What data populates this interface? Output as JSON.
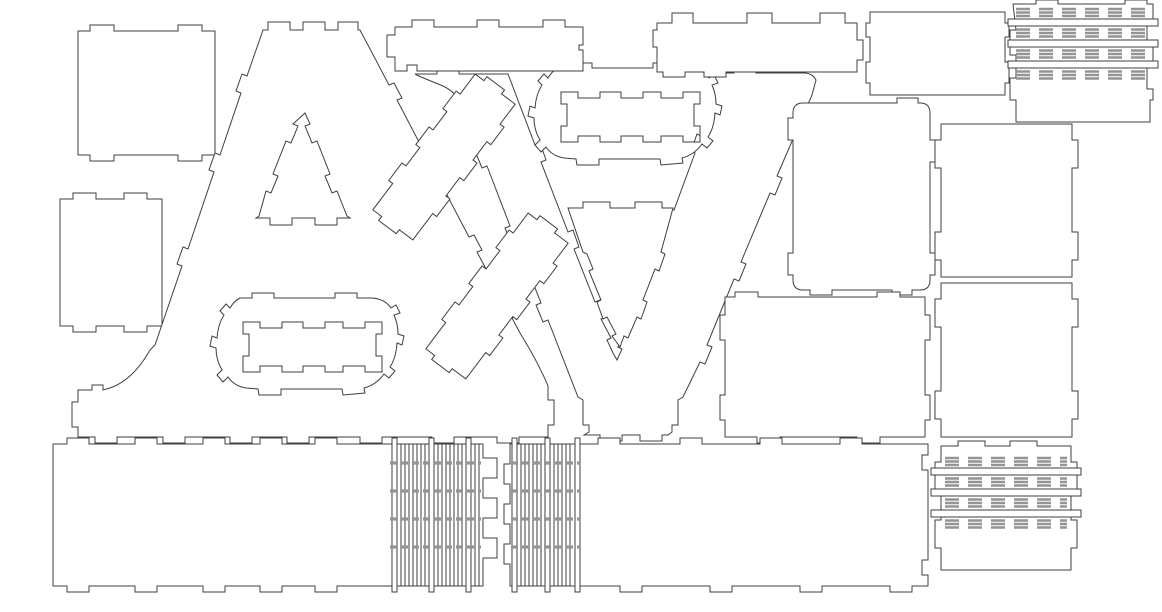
{
  "canvas": {
    "width": 1162,
    "height": 612,
    "background_color": "#ffffff",
    "cut_line_color": "#3f3f3f",
    "kerf_line_color": "#949494",
    "description": "laser-cut nesting sheet for 3D marquee letters A and V",
    "pieces": [
      {
        "name": "panel-square-top-left",
        "kind": "path",
        "d": "M78,31 L90,31 L90,25 L114,25 L114,31 L178,31 L178,25 L202,25 L202,31 L215,31 L215,155 L202,155 L202,161 L178,161 L178,155 L114,155 L114,161 L90,161 L90,155 L78,155 Z"
      },
      {
        "name": "panel-rect-left",
        "kind": "path",
        "d": "M60,199 L73,199 L73,193 L96,193 L96,199 L124,199 L124,193 L147,193 L147,199 L162,199 L162,326 L147,326 L147,332 L124,332 L124,326 L96,326 L96,332 L73,332 L73,326 L60,326 Z"
      },
      {
        "name": "letter-a-face",
        "kind": "path",
        "d": "M263,30 L268,30 L268,22 L290,22 L290,30 L303,30 L303,22 L325,22 L325,30 L338,30 L338,22 L358,22 L358,30 L360,30 L389,85 L394,83 L402,98 L397,100 L430,163 L435,161 L443,176 L438,178 L469,237 L474,235 L482,250 L477,252 L504,303 L509,301 L517,316 L512,318 L520,333 Q538,362 548,386 L548,400 L554,400 L554,425 L548,425 L548,437 L519,437 L519,443 L497,443 L497,437 L454,437 L454,443 L432,443 L432,437 L382,437 L382,443 L360,443 L360,437 L309,437 L309,443 L287,443 L287,437 L252,437 L252,443 L230,443 L230,437 L185,437 L185,443 L163,443 L163,437 L117,437 L117,443 L95,443 L95,437 L78,437 L78,427 L72,427 L72,402 L78,402 L78,390 L92,390 L92,385 L103,385 L103,390 L110,388 Q133,380 150,350 L155,345 L182,266 L177,264 L183,247 L188,249 L214,172 L209,170 L215,153 L220,155 L241,93 L236,91 L242,74 L247,76 Z"
      },
      {
        "name": "letter-a-counter-triangle",
        "kind": "path",
        "d": "M305,113 L310,124 L305,126 L312,143 L317,141 L330,174 L325,176 L332,193 L337,191 L347,216 L350,218 L337,218 L337,225 L315,225 L315,218 L292,218 L292,225 L270,225 L270,218 L256,218 L259,216 L266,191 L271,193 L278,176 L273,174 L286,141 L291,143 L298,126 L293,124 Z"
      },
      {
        "name": "letter-a-counter-stadium",
        "kind": "path",
        "transform": "translate(215,298)",
        "d": "M25,0 L37,0 L37,-5 L59,-5 L59,0 L120,0 L120,-5 L142,-5 L142,0 L157,0 Q170,1 176,10 L181,7 L185,15 L179,17 Q183,26 183,36 L189,38 L187,47 L182,45 Q181,60 175,69 L180,73 L174,80 L169,76 Q161,87 149,90 L150,95 L128,97 L127,91 L66,91 L66,97 L44,97 L43,91 L31,90 Q19,88 13,79 L8,84 L2,77 L7,72 Q1,62 1,50 L-5,48 L-3,38 L2,40 Q3,26 9,17 L5,13 L11,6 L15,10 Q19,3 25,0 Z M28,24 L45,24 L45,30 L67,30 L67,24 L88,24 L88,30 L110,30 L110,24 L128,24 L128,30 L150,30 L150,24 L167,24 L167,36 L161,36 L161,58 L167,58 L167,74 L150,74 L150,68 L128,68 L128,74 L110,74 L110,68 L88,68 L88,74 L67,74 L67,68 L45,68 L45,74 L28,74 L28,58 L34,58 L34,36 L28,36 Z"
      },
      {
        "name": "letter-v-face",
        "kind": "path",
        "d": "M415,74 L437,74 L437,69 L459,69 L459,74 L508,74 L535,145 L540,143 L546,160 L541,162 L568,232 L573,230 L579,247 L574,249 L595,302 L600,300 L606,317 L601,319 L611,338 L607,340 L613,353 L617,360 L622,349 L618,347 L623,335 L627,337 L641,300 L637,298 L643,281 L647,283 L668,227 L664,225 L670,208 L674,210 L695,153 L691,151 L697,134 L701,136 L710,112 L710,80 L712,73 L734,73 L734,68 L756,68 L756,73 L806,73 Q813,74 816,80 L812,95 L777,176 L782,178 L775,195 L770,193 L741,262 L746,264 L739,281 L734,279 L707,345 L712,347 L705,364 L700,362 L683,397 L678,400 L678,425 L672,425 L672,432 L668,435 L662,435 L662,441 L640,441 L640,435 L622,435 L622,441 L600,441 L600,435 L584,435 L589,432 L589,425 L583,425 L583,400 L578,397 L548,320 L543,322 L536,305 L541,303 L517,243 L512,245 L505,228 L510,226 L487,166 L482,168 L475,151 L480,149 L463,106 Q456,92 443,86 L421,77 Z"
      },
      {
        "name": "letter-v-counter-triangle",
        "kind": "path",
        "d": "M568,208 L583,208 L583,202 L610,202 L610,208 L635,208 L635,202 L662,202 L662,208 L673,208 L661,252 L665,254 L659,271 L655,269 L643,300 L647,302 L641,319 L637,317 L628,338 L624,336 L620,347 L612,336 L616,334 L607,317 L603,319 L597,302 L601,300 L589,271 L593,269 L587,254 L583,252 Z"
      },
      {
        "name": "letter-v-counter-stadium",
        "kind": "path",
        "transform": "translate(533,68)",
        "d": "M25,0 L37,0 L37,-5 L59,-5 L59,0 L120,0 L120,-5 L142,-5 L142,0 L157,0 Q170,1 176,10 L181,7 L185,15 L179,17 Q183,26 183,36 L189,38 L187,47 L182,45 Q181,60 175,69 L180,73 L174,80 L169,76 Q161,87 149,90 L150,95 L128,97 L127,91 L66,91 L66,97 L44,97 L43,91 L31,90 Q19,88 13,79 L8,84 L2,77 L7,72 Q1,62 1,50 L-5,48 L-3,38 L2,40 Q3,26 9,17 L5,13 L11,6 L15,10 Q19,3 25,0 Z M28,24 L45,24 L45,30 L67,30 L67,24 L88,24 L88,30 L110,30 L110,24 L128,24 L128,30 L150,30 L150,24 L167,24 L167,36 L161,36 L161,58 L167,58 L167,74 L150,74 L150,68 L128,68 L128,74 L110,74 L110,68 L88,68 L88,74 L67,74 L67,68 L45,68 L45,74 L28,74 L28,58 L34,58 L34,36 L28,36 Z"
      },
      {
        "name": "strip-diagonal-1",
        "kind": "path",
        "transform": "translate(444,157) rotate(37)",
        "d": "M-25,-85 L-14,-85 L-14,-90 L8,-90 L8,-85 L25,-85 L25,-60 L30,-60 L30,-38 L25,-38 L25,-15 L30,-15 L30,7 L25,7 L25,30 L30,30 L30,52 L25,52 L25,85 L8,85 L8,90 L-14,90 L-14,85 L-25,85 L-25,52 L-30,52 L-30,30 L-25,30 L-25,7 L-30,7 L-30,-15 L-25,-15 L-25,-38 L-30,-38 L-30,-60 L-25,-60 Z"
      },
      {
        "name": "strip-diagonal-2",
        "kind": "path",
        "transform": "translate(497,296) rotate(37)",
        "d": "M-25,-85 L-14,-85 L-14,-90 L8,-90 L8,-85 L25,-85 L25,-60 L30,-60 L30,-38 L25,-38 L25,-15 L30,-15 L30,7 L25,7 L25,30 L30,30 L30,52 L25,52 L25,85 L8,85 L8,90 L-14,90 L-14,85 L-25,85 L-25,52 L-30,52 L-30,30 L-25,30 L-25,7 L-30,7 L-30,-15 L-25,-15 L-25,-38 L-30,-38 L-30,-60 L-25,-60 Z"
      },
      {
        "name": "panel-rect-top-center-a",
        "kind": "path",
        "d": "M395,27 L412,27 L412,20 L434,20 L434,27 L477,27 L477,20 L499,20 L499,27 L543,27 L543,20 L565,20 L565,27 L583,27 L583,45 L579,45 L579,50 L583,50 L583,71 L417,71 L417,65 L407,65 L407,71 L395,71 L395,57 L387,57 L387,35 L395,35 Z"
      },
      {
        "name": "panel-rect-top-center-v",
        "kind": "path",
        "d": "M657,23 L672,23 L672,13 L693,13 L693,23 L747,23 L747,13 L772,13 L772,23 L820,23 L820,13 L845,13 L845,23 L857,23 L857,40 L863,40 L863,60 L857,60 L857,72 L726,72 L726,77 L704,77 L704,72 L685,72 L685,77 L663,77 L663,72 L657,72 L657,47 L653,47 L653,30 L657,30 Z"
      },
      {
        "name": "panel-rect-top-right",
        "kind": "path",
        "d": "M870,12 L1005,12 L1005,23 L1009,23 L1009,37 L1005,37 L1005,62 L1009,62 L1009,83 L1005,83 L1005,95 L870,95 L870,83 L866,83 L866,62 L870,62 L870,37 L866,37 L866,23 L870,23 Z"
      },
      {
        "name": "hinge-panel-top-right",
        "kind": "hinge",
        "frame": "M1013,4 L1036,4 L1036,0 L1058,0 L1058,4 L1125,4 L1125,0 L1147,0 L1147,4 L1153,4 L1153,26 L1147,26 L1147,47 L1153,47 L1153,68 L1147,68 L1147,89 L1153,89 L1153,100 L1150,100 L1150,122 L1016,122 L1016,100 L1010,100 L1010,78 L1016,78 L1016,55 L1010,55 L1010,30 L1016,30 Z",
        "slots": [
          {
            "x": 1008,
            "y": 19,
            "w": 150,
            "h": 7
          },
          {
            "x": 1008,
            "y": 40,
            "w": 150,
            "h": 7
          },
          {
            "x": 1008,
            "y": 61,
            "w": 150,
            "h": 7
          }
        ],
        "row_x1": 1016,
        "row_x2": 1150,
        "rows": [
          9,
          12.5,
          16,
          29.5,
          33,
          36.5,
          50.5,
          54,
          57.5,
          71.5,
          75,
          78.5
        ]
      },
      {
        "name": "panel-rounded-right-of-v",
        "kind": "path",
        "d": "M803,103 L897,103 L897,98 L918,98 L918,103 L920,103 Q930,103 930,113 L930,140 L935,140 L935,162 L930,162 L930,253 L935,253 L935,275 L930,275 L930,280 Q930,290 920,290 L912,290 L912,295 L892,295 L892,290 L832,290 L832,295 L810,295 L810,290 L803,290 Q793,290 793,280 L793,275 L788,275 L788,253 L793,253 L793,140 L788,140 L788,118 L793,118 L793,113 Q793,103 803,103 Z"
      },
      {
        "name": "panel-rect-mid-right",
        "kind": "path",
        "d": "M725,297 L735,297 L735,292 L758,292 L758,297 L877,297 L877,292 L900,292 L900,297 L925,297 L925,315 L930,315 L930,340 L925,340 L925,395 L930,395 L930,420 L925,420 L925,437 L880,437 L880,443 L857,443 L857,437 L780,437 L780,443 L757,443 L757,437 L725,437 L725,420 L720,420 L720,395 L725,395 L725,340 L720,340 L720,315 L725,315 Z"
      },
      {
        "name": "panel-square-right-1",
        "kind": "path",
        "d": "M941,124 L1072,124 L1072,140 L1078,140 L1078,168 L1072,168 L1072,232 L1078,232 L1078,260 L1072,260 L1072,277 L941,277 L941,260 L935,260 L935,232 L941,232 L941,168 L935,168 L935,140 L941,140 Z"
      },
      {
        "name": "panel-square-right-2",
        "kind": "path",
        "d": "M941,283 L1072,283 L1072,299 L1078,299 L1078,327 L1072,327 L1072,391 L1078,391 L1078,419 L1072,419 L1072,437 L941,437 L941,419 L935,419 L935,391 L941,391 L941,327 L935,327 L935,299 L941,299 Z"
      },
      {
        "name": "panel-bottom-left-long",
        "kind": "path",
        "d": "M53,444 L67,444 L67,438 L89,438 L89,444 L135,444 L135,438 L157,438 L157,444 L203,444 L203,438 L225,438 L225,444 L260,444 L260,438 L282,438 L282,444 L315,444 L315,438 L337,438 L337,444 L483,444 L483,458 L497,458 L497,478 L483,478 L483,498 L497,498 L497,518 L483,518 L483,538 L497,538 L497,558 L483,558 L483,586 L337,586 L337,592 L315,592 L315,586 L282,586 L282,592 L260,592 L260,586 L225,586 L225,592 L203,592 L203,586 L157,586 L157,592 L135,592 L135,586 L89,586 L89,592 L67,592 L67,586 L53,586 Z"
      },
      {
        "name": "comb-strips-bottom-left",
        "kind": "comb",
        "y1": 444,
        "y2": 586,
        "yb1": 438,
        "yb2": 592,
        "bars": [
          392,
          429,
          466
        ],
        "bar_w": 5,
        "lines": [
          401,
          405,
          409,
          413,
          417,
          421,
          425,
          438,
          442,
          446,
          450,
          454,
          458,
          462,
          475,
          479
        ],
        "row_x1": 390,
        "row_x2": 481,
        "rows": [
          463,
          491,
          519,
          547
        ]
      },
      {
        "name": "panel-bottom-right-long",
        "kind": "path",
        "d": "M510,444 L598,444 L598,438 L620,438 L620,444 L680,444 L680,438 L702,438 L702,444 L760,444 L760,438 L782,438 L782,444 L840,444 L840,438 L862,438 L862,444 L928,444 L928,455 L922,455 L922,470 L928,470 L928,560 L922,560 L922,575 L928,575 L928,586 L912,586 L912,592 L890,592 L890,586 L822,586 L822,592 L800,592 L800,586 L732,586 L732,592 L710,592 L710,586 L642,586 L642,592 L620,592 L620,586 L510,586 L510,564 L504,564 L504,544 L510,544 L510,524 L504,524 L504,504 L510,504 L510,484 L504,484 L504,464 L510,464 Z"
      },
      {
        "name": "comb-strips-bottom-mid",
        "kind": "comb",
        "y1": 444,
        "y2": 586,
        "yb1": 438,
        "yb2": 592,
        "bars": [
          512,
          545,
          575
        ],
        "bar_w": 5,
        "lines": [
          521,
          525,
          529,
          533,
          537,
          541,
          554,
          558,
          562,
          566,
          570
        ],
        "row_x1": 511,
        "row_x2": 580,
        "rows": [
          463,
          491,
          519,
          547
        ]
      },
      {
        "name": "hinge-panel-bottom-right",
        "kind": "hinge",
        "frame": "M941,446 L958,446 L958,441 L985,441 L985,446 L1010,446 L1010,441 L1037,441 L1037,446 L1071,446 L1071,462 L1077,462 L1077,490 L1071,490 L1071,520 L1077,520 L1077,548 L1071,548 L1071,570 L941,570 L941,548 L935,548 L935,520 L941,520 L941,490 L935,490 L935,462 L941,462 Z",
        "slots": [
          {
            "x": 931,
            "y": 468,
            "w": 150,
            "h": 7
          },
          {
            "x": 931,
            "y": 489,
            "w": 150,
            "h": 7
          },
          {
            "x": 931,
            "y": 510,
            "w": 150,
            "h": 7
          }
        ],
        "row_x1": 945,
        "row_x2": 1067,
        "rows": [
          458,
          461.5,
          465,
          478.5,
          482,
          485.5,
          499.5,
          503,
          506.5,
          520.5,
          524,
          527.5
        ]
      }
    ]
  }
}
